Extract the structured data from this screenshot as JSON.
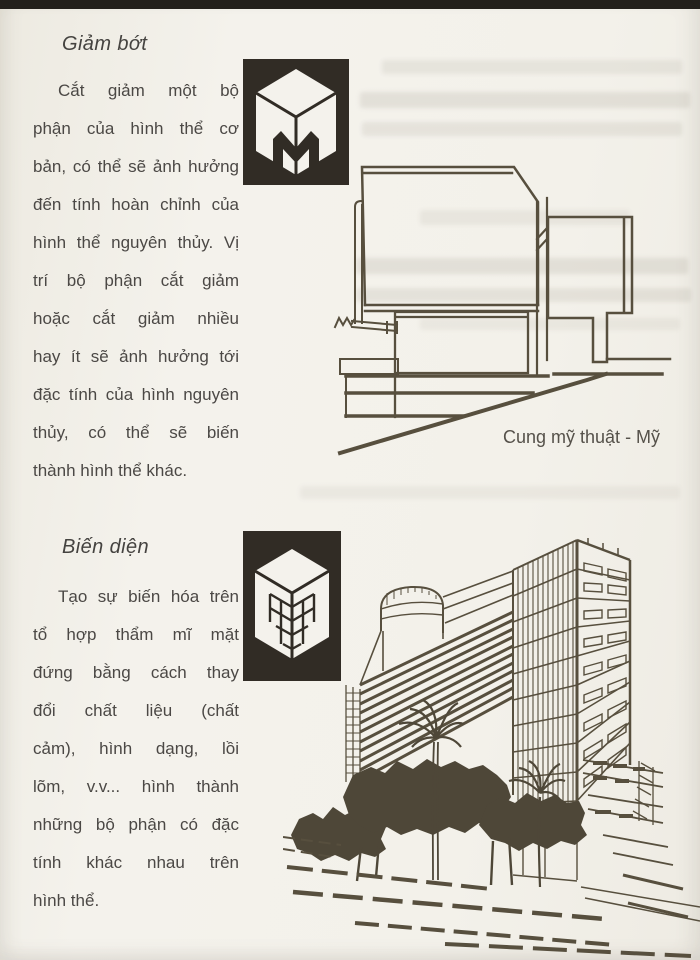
{
  "sections": [
    {
      "heading": "Giảm bớt",
      "lines": [
        "Cắt giảm một bộ",
        "phận của hình thể cơ",
        "bản, có thể sẽ ảnh hưởng",
        "đến tính hoàn chỉnh của",
        "hình thể nguyên thủy. Vị",
        "trí bộ phận cắt giảm",
        "hoặc cắt giảm nhiều",
        "hay ít sẽ ảnh hưởng tới",
        "đặc tính của hình nguyên",
        "thủy, có thể sẽ biến",
        "thành hình thể khác."
      ]
    },
    {
      "heading": "Biến diện",
      "lines": [
        "Tạo sự biến hóa trên",
        "tổ hợp thẩm mĩ mặt",
        "đứng bằng cách thay",
        "đổi chất liệu (chất",
        "cảm), hình dạng, lồi",
        "lõm, v.v... hình thành",
        "những bộ phận có đặc",
        "tính khác nhau trên",
        "hình thể."
      ]
    }
  ],
  "figures": [
    {
      "icon_name": "cube-subtraction-icon",
      "caption": "Cung mỹ thuật - Mỹ"
    },
    {
      "icon_name": "cube-surface-grid-icon",
      "caption": ""
    }
  ],
  "colors": {
    "paper": "#f3f1ea",
    "ink": "#4b4845",
    "line_art": "#574f3e",
    "icon_background": "#312c25",
    "top_edge_bar": "#23201b"
  }
}
